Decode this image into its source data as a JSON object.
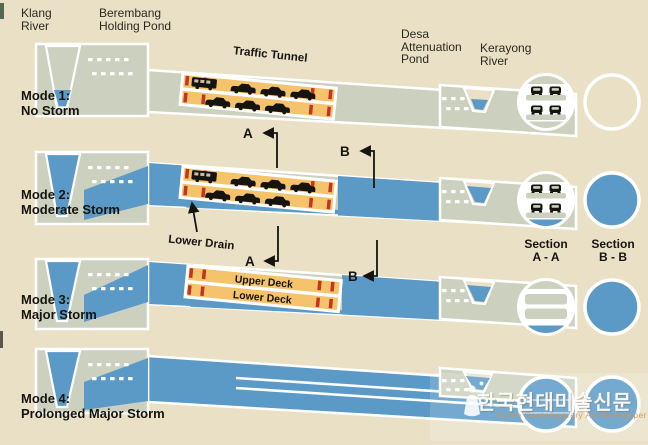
{
  "top_labels": {
    "klang": [
      "Klang",
      "River"
    ],
    "berembang": [
      "Berembang",
      "Holding Pond"
    ],
    "desa": [
      "Desa",
      "Attenuation",
      "Pond"
    ],
    "kerayong": [
      "Kerayong",
      "River"
    ]
  },
  "modes": [
    {
      "name": "Mode 1:",
      "condition": "No Storm"
    },
    {
      "name": "Mode 2:",
      "condition": "Moderate Storm"
    },
    {
      "name": "Mode 3:",
      "condition": "Major Storm"
    },
    {
      "name": "Mode 4:",
      "condition": "Prolonged Major Storm"
    }
  ],
  "annotations": {
    "traffic_tunnel": "Traffic Tunnel",
    "lower_drain": "Lower Drain",
    "upper_deck": "Upper Deck",
    "lower_deck": "Lower Deck",
    "marker_a": "A",
    "marker_b": "B"
  },
  "sections": {
    "a_label": [
      "Section",
      "A - A"
    ],
    "b_label": [
      "Section",
      "B - B"
    ]
  },
  "watermark": {
    "korean": "한국현대미술신문",
    "english": "Korea Contemporary Art Newspaper"
  },
  "colors": {
    "background": "#e9e0c6",
    "structure_gray": "#ccd1bf",
    "water_blue": "#5b9ac7",
    "tunnel_orange": "#f4c36b",
    "dash_red": "#c23522",
    "outline_white": "#ffffff",
    "text_black": "#15140f"
  }
}
